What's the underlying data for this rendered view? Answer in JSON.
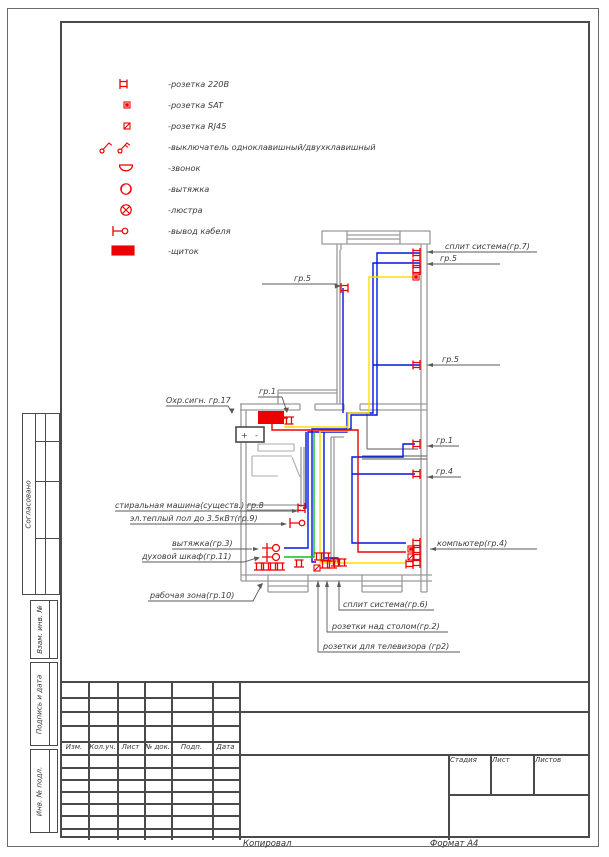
{
  "page": {
    "copied": "Копировал",
    "format": "Формат А4"
  },
  "colors": {
    "accent": "#ee0000",
    "wire_blue": "#0016e0",
    "wire_yellow": "#ffdf00",
    "wire_green": "#12c212",
    "wire_red": "#f00000",
    "wall": "#9a9a9a",
    "leader": "#5a5a5a"
  },
  "legend": {
    "items": [
      {
        "icon": "socket-220-icon",
        "label": "-розетка 220В"
      },
      {
        "icon": "socket-sat-icon",
        "label": "-розетка SAT"
      },
      {
        "icon": "socket-rj45-icon",
        "label": "-розетка RJ45"
      },
      {
        "icon": "switch-icon",
        "label": "-выключатель одноклавишный/двухклавишный"
      },
      {
        "icon": "bell-icon",
        "label": "-звонок"
      },
      {
        "icon": "extract-fan-icon",
        "label": "-вытяжка"
      },
      {
        "icon": "chandelier-icon",
        "label": "-люстра"
      },
      {
        "icon": "cable-outlet-icon",
        "label": "-вывод кабеля"
      },
      {
        "icon": "panel-icon",
        "label": "-щиток"
      }
    ]
  },
  "plan": {
    "labels": {
      "split7": "сплит система(гр.7)",
      "gr5_a": "гр.5",
      "gr5_b": "гр.5",
      "gr5_left": "гр.5",
      "gr1_top": "гр.1",
      "okhr": "Охр.сигн. гр.17",
      "gr1_right": "гр.1",
      "gr4_right": "гр.4",
      "washer": "стиральная машина(существ.) гр.8",
      "heated_floor": "эл.теплый пол до 3.5кВт(гр.9)",
      "extract": "вытяжка(гр.3)",
      "oven": "духовой шкаф(гр.11)",
      "work_zone": "рабочая зона(гр.10)",
      "computer": "компьютер(гр.4)",
      "split6": "сплит система(гр.6)",
      "desk": "розетки над столом(гр.2)",
      "tv": "розетки для телевизора (гр2)",
      "battery_plus": "+",
      "battery_minus": "-"
    }
  },
  "titleblock": {
    "cols": [
      "Изм.",
      "Кол.уч.",
      "Лист",
      "№ док.",
      "Подп.",
      "Дата"
    ],
    "stage": "Стадия",
    "sheet": "Лист",
    "sheets": "Листов"
  },
  "side": {
    "approved": "Согласовано",
    "replace_inv": "Взам. инв. №",
    "sign_date": "Подпись и дата",
    "inv_orig": "Инв. № подл."
  }
}
